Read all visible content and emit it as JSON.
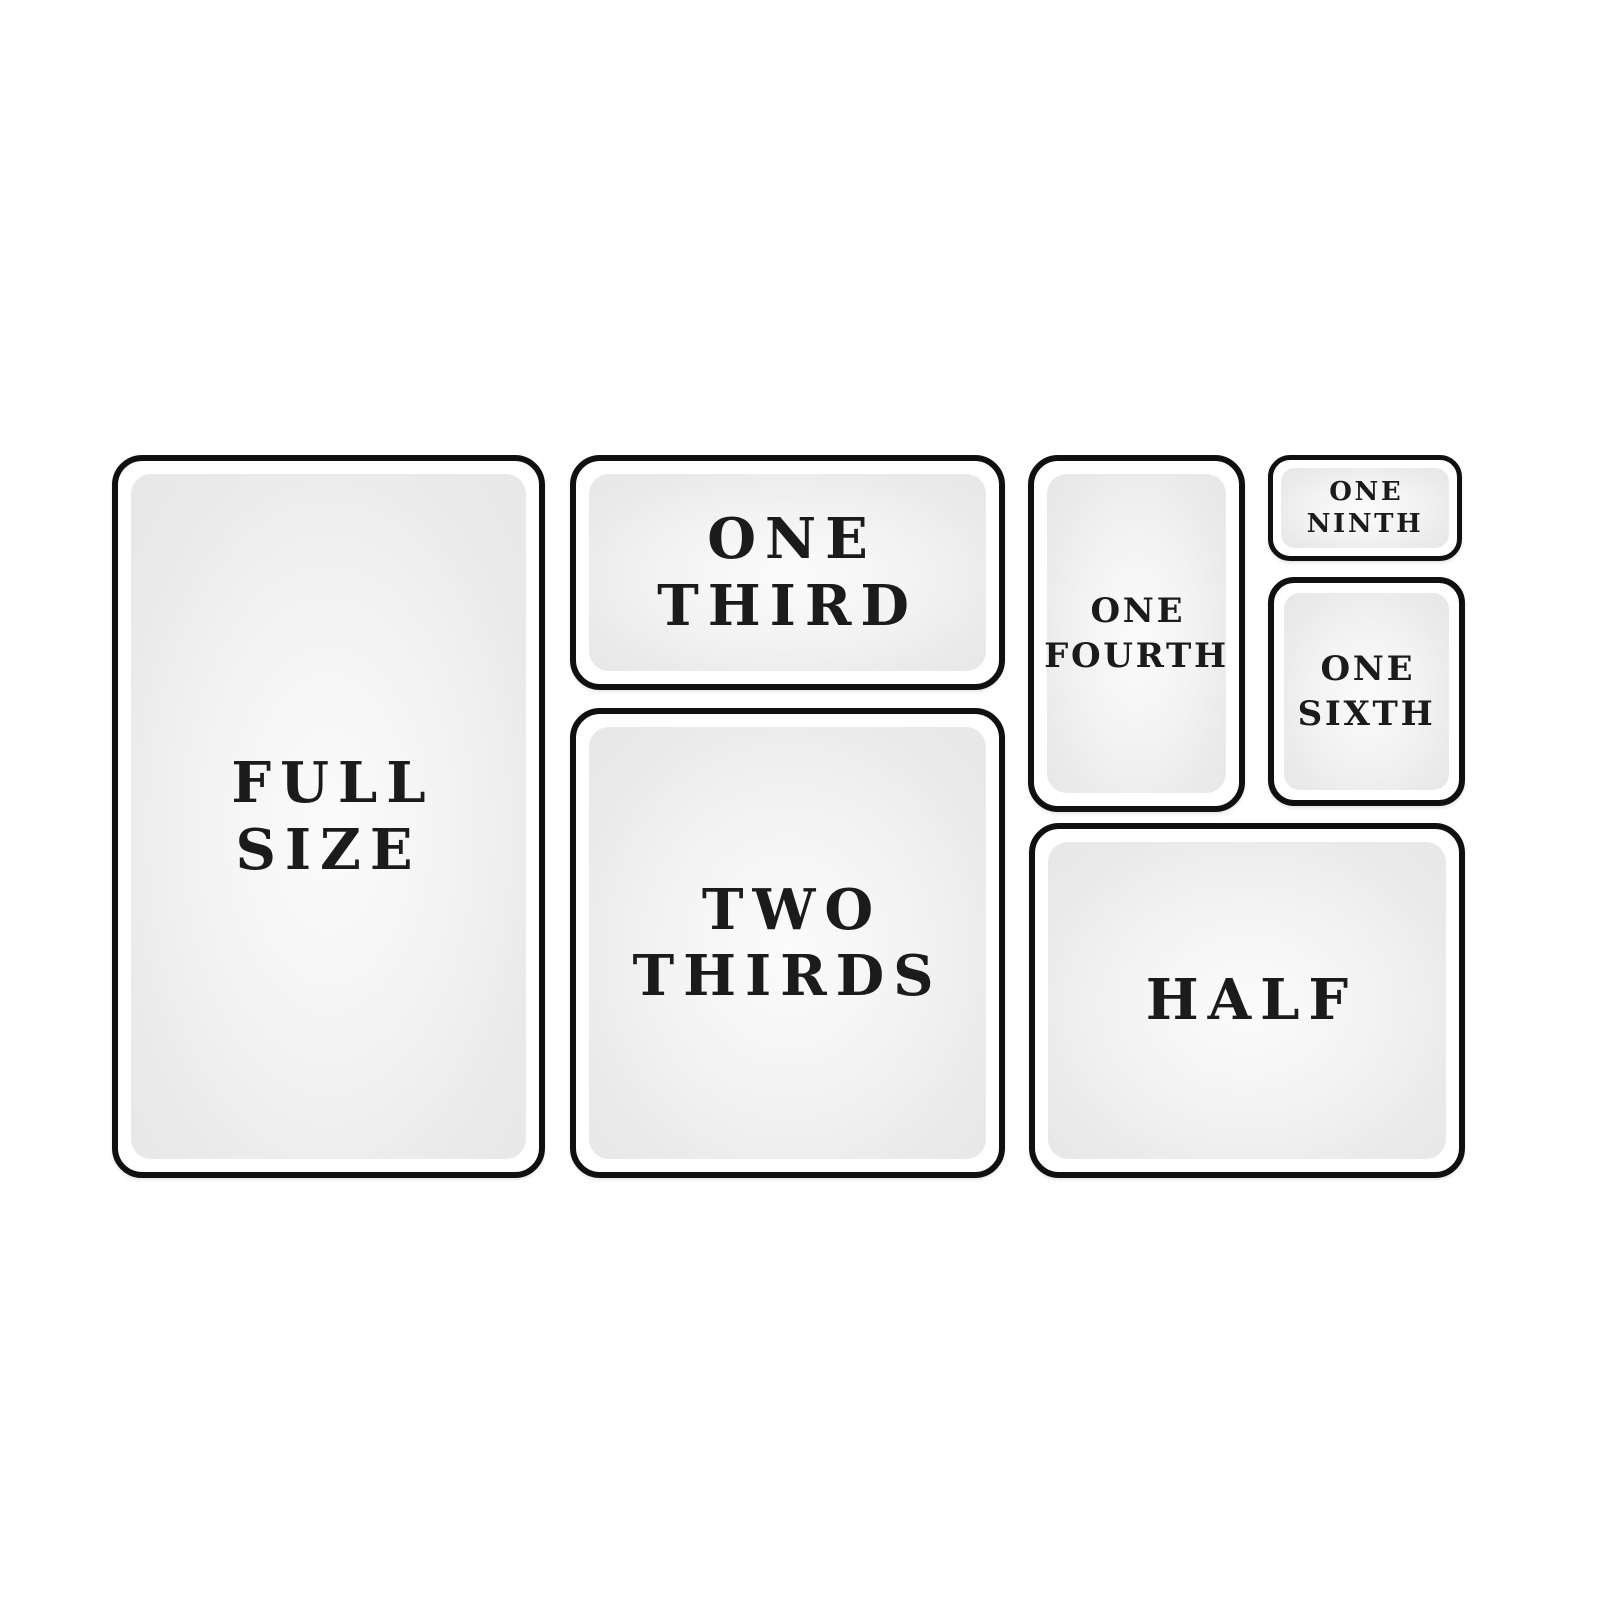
{
  "diagram": {
    "name": "food-pan-sizes",
    "colors": {
      "background": "#ffffff",
      "border": "#101010",
      "panel_edge": "#e7e7e7",
      "panel_center": "#fbfbfb",
      "text": "#1b1b1b"
    },
    "pans": [
      {
        "id": "full-size",
        "label": "FULL\nSIZE"
      },
      {
        "id": "one-third",
        "label": "ONE\nTHIRD"
      },
      {
        "id": "two-thirds",
        "label": "TWO\nTHIRDS"
      },
      {
        "id": "one-fourth",
        "label": "ONE\nFOURTH"
      },
      {
        "id": "one-ninth",
        "label": "ONE\nNINTH"
      },
      {
        "id": "one-sixth",
        "label": "ONE\nSIXTH"
      },
      {
        "id": "half",
        "label": "HALF"
      }
    ]
  }
}
